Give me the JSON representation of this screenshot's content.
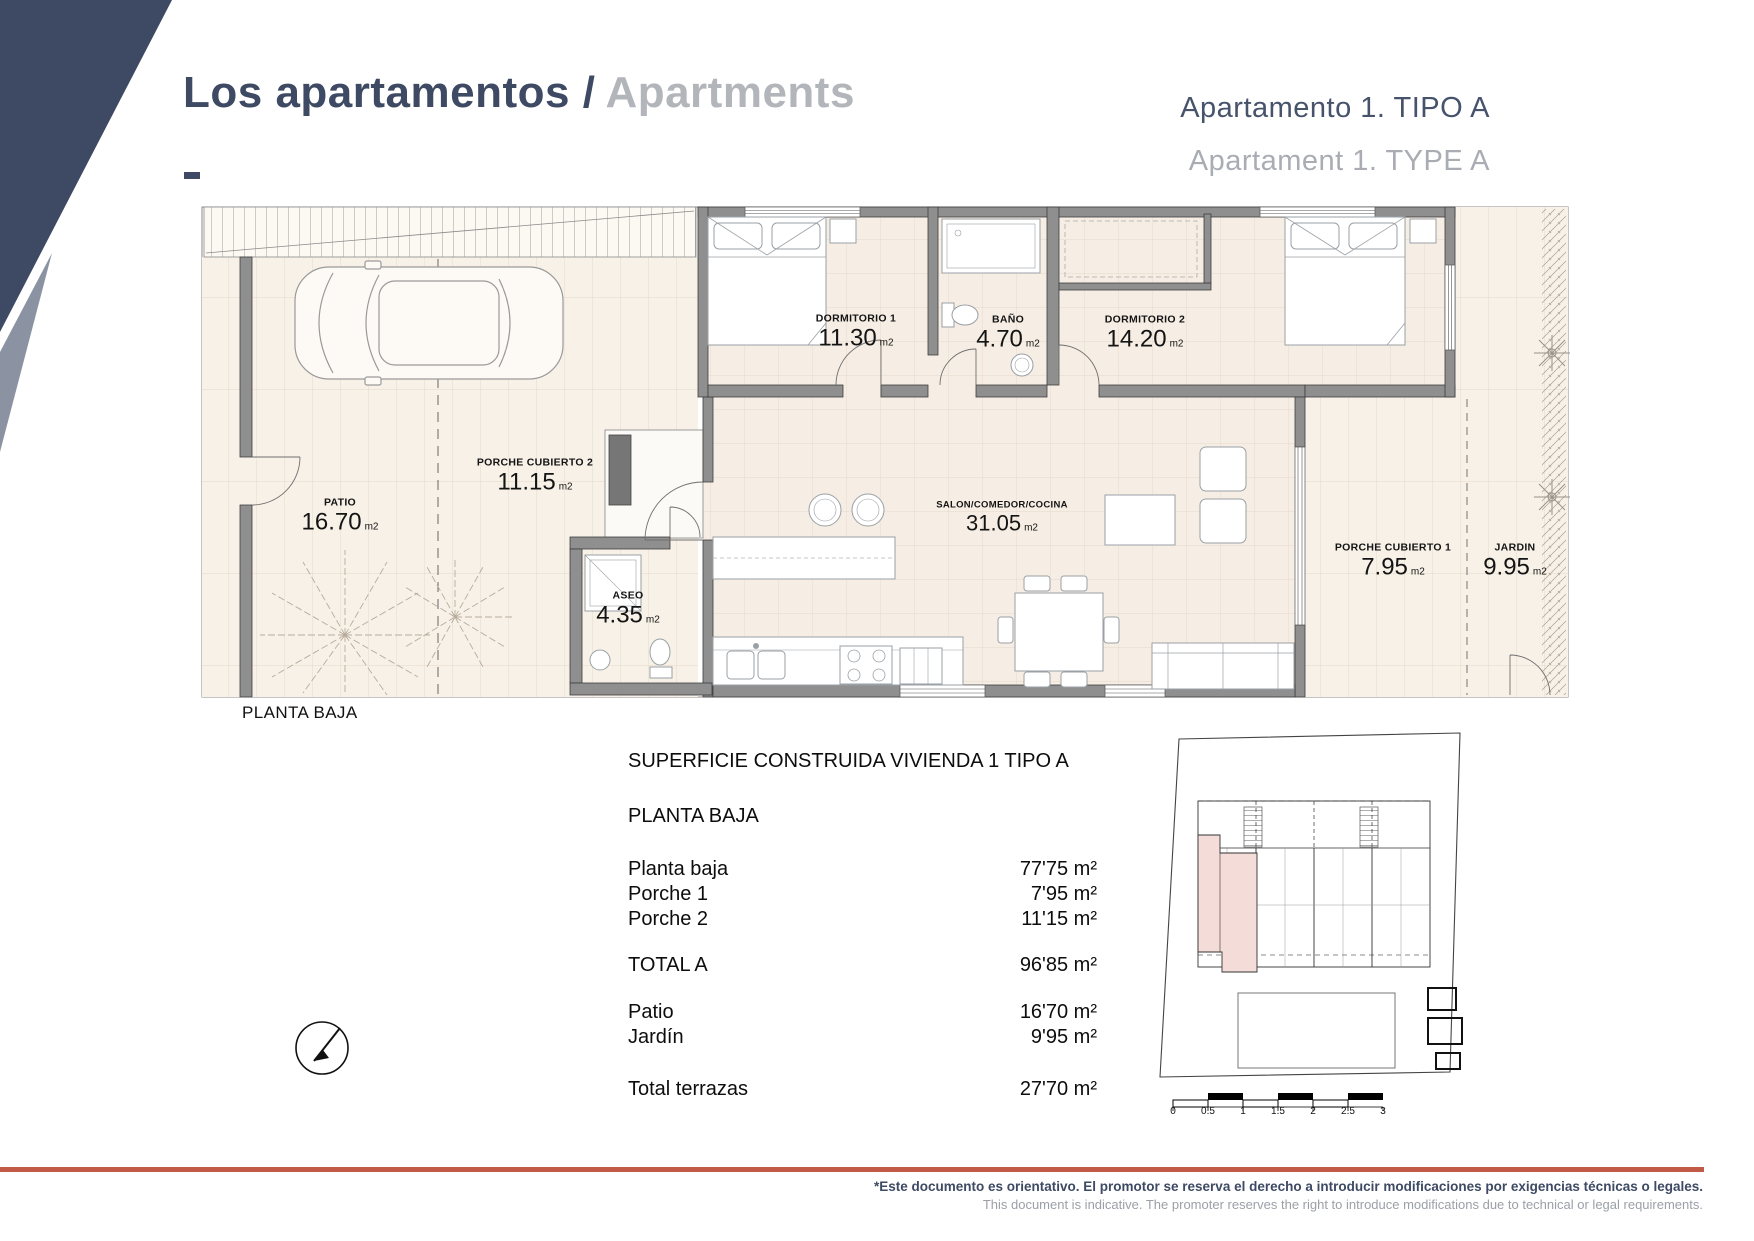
{
  "header": {
    "title_primary": "Los apartamentos /",
    "title_secondary": "Apartments",
    "unit_title_primary": "Apartamento 1. TIPO A",
    "unit_title_secondary": "Apartament 1. TYPE A"
  },
  "floor_plan": {
    "caption": "PLANTA BAJA",
    "rooms": [
      {
        "name": "DORMITORIO 1",
        "area": "11.30",
        "unit": "m2"
      },
      {
        "name": "BAÑO",
        "area": "4.70",
        "unit": "m2"
      },
      {
        "name": "DORMITORIO 2",
        "area": "14.20",
        "unit": "m2"
      },
      {
        "name": "PORCHE CUBIERTO 2",
        "area": "11.15",
        "unit": "m2"
      },
      {
        "name": "PATIO",
        "area": "16.70",
        "unit": "m2"
      },
      {
        "name": "SALON/COMEDOR/COCINA",
        "area": "31.05",
        "unit": "m2"
      },
      {
        "name": "ASEO",
        "area": "4.35",
        "unit": "m2"
      },
      {
        "name": "PORCHE CUBIERTO 1",
        "area": "7.95",
        "unit": "m2"
      },
      {
        "name": "JARDIN",
        "area": "9.95",
        "unit": "m2"
      }
    ]
  },
  "surface_table": {
    "title": "SUPERFICIE CONSTRUIDA VIVIENDA 1 TIPO A",
    "section": "PLANTA BAJA",
    "rows": [
      {
        "label": "Planta baja",
        "value": "77'75 m²"
      },
      {
        "label": "Porche 1",
        "value": "7'95 m²"
      },
      {
        "label": "Porche 2",
        "value": "11'15 m²"
      }
    ],
    "total_row": {
      "label": "TOTAL A",
      "value": "96'85 m²"
    },
    "terrace_rows": [
      {
        "label": "Patio",
        "value": "16'70 m²"
      },
      {
        "label": "Jardín",
        "value": "9'95 m²"
      }
    ],
    "terrace_total_row": {
      "label": "Total terrazas",
      "value": "27'70 m²"
    }
  },
  "site_plan": {
    "scale_ticks": [
      "0",
      "0.5",
      "1",
      "1.5",
      "2",
      "2.5",
      "3"
    ]
  },
  "footer": {
    "disclaimer_primary": "*Este documento es orientativo. El promotor se reserva el derecho a introducir modificaciones por exigencias técnicas o legales.",
    "disclaimer_secondary": "This document is indicative. The promoter reserves the right to introduce modifications due to technical or legal requirements."
  },
  "colors": {
    "accent_navy": "#3e4a63",
    "accent_gray": "#aeb1b6",
    "accent_terracotta": "#c15b46",
    "plan_floor": "#f7f0e7",
    "highlight_pink": "#f4dcd8"
  }
}
